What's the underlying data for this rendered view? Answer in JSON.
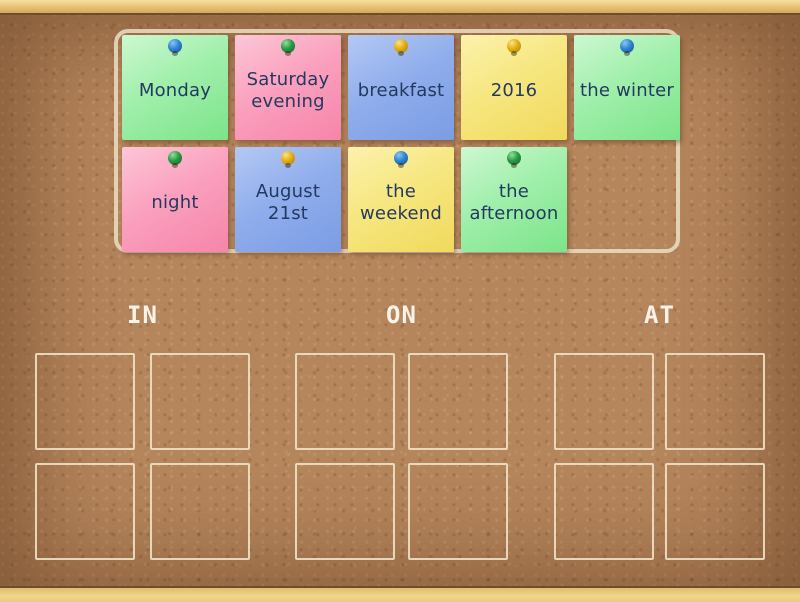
{
  "board": {
    "categories": [
      {
        "label": "IN"
      },
      {
        "label": "ON"
      },
      {
        "label": "AT"
      }
    ],
    "slots_per_category": 4,
    "cards": [
      {
        "text": "Monday",
        "note_color": "green",
        "pin_color": "blue"
      },
      {
        "text": "Saturday evening",
        "note_color": "pink",
        "pin_color": "green"
      },
      {
        "text": "breakfast",
        "note_color": "blue",
        "pin_color": "yellow"
      },
      {
        "text": "2016",
        "note_color": "yellow",
        "pin_color": "yellow"
      },
      {
        "text": "the winter",
        "note_color": "green",
        "pin_color": "blue"
      },
      {
        "text": "night",
        "note_color": "pink",
        "pin_color": "green"
      },
      {
        "text": "August 21st",
        "note_color": "blue",
        "pin_color": "yellow"
      },
      {
        "text": "the weekend",
        "note_color": "yellow",
        "pin_color": "blue"
      },
      {
        "text": "the afternoon",
        "note_color": "green",
        "pin_color": "green"
      }
    ],
    "colors": {
      "cork_background": "#b5855c",
      "wood_frame": "#eccb7e",
      "note_green": "#94eca1",
      "note_pink": "#f99cba",
      "note_blue": "#8aa9ea",
      "note_yellow": "#f5e57e",
      "note_text": "#23395f",
      "category_label_text": "#f7f3e8",
      "slot_border": "#ecdfc4",
      "pin_blue": "#2f84d0",
      "pin_green": "#2a9a44",
      "pin_yellow": "#e2ae13"
    }
  }
}
